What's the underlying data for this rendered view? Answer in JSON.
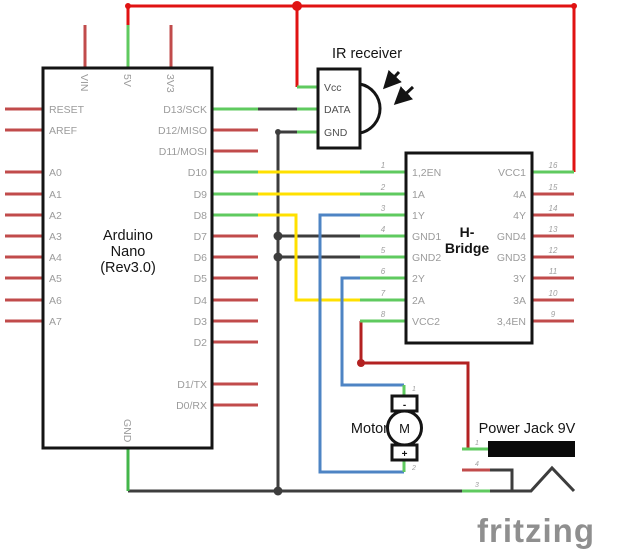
{
  "colors": {
    "wire_red": "#e01212",
    "wire_dark_red": "#b32121",
    "wire_green": "#43b64a",
    "wire_yellow": "#ffe000",
    "wire_blue": "#4e84c4",
    "wire_black": "#3d3d3d",
    "pin_stub_red": "#c14b4b",
    "pin_stub_green": "#5fca5f",
    "pin_label_gray": "#9b9b9b",
    "component_text": "#141414",
    "watermark_gray": "#8f8f8f"
  },
  "arduino": {
    "title_lines": [
      "Arduino",
      "Nano",
      "(Rev3.0)"
    ],
    "pins_left": [
      "RESET",
      "AREF",
      "A0",
      "A1",
      "A2",
      "A3",
      "A4",
      "A5",
      "A6",
      "A7"
    ],
    "pins_right": [
      "D13/SCK",
      "D12/MISO",
      "D11/MOSI",
      "D10",
      "D9",
      "D8",
      "D7",
      "D6",
      "D5",
      "D4",
      "D3",
      "D2",
      "D1/TX",
      "D0/RX"
    ],
    "pins_top": [
      "VIN",
      "5V",
      "3V3"
    ],
    "pin_bottom": "GND"
  },
  "ir_receiver": {
    "title": "IR receiver",
    "pins": [
      "Vcc",
      "DATA",
      "GND"
    ]
  },
  "hbridge": {
    "title_lines": [
      "H-",
      "Bridge"
    ],
    "pins_left": [
      "1,2EN",
      "1A",
      "1Y",
      "GND1",
      "GND2",
      "2Y",
      "2A",
      "VCC2"
    ],
    "pin_numbers_left": [
      "1",
      "2",
      "3",
      "4",
      "5",
      "6",
      "7",
      "8"
    ],
    "pins_right": [
      "VCC1",
      "4A",
      "4Y",
      "GND4",
      "GND3",
      "3Y",
      "3A",
      "3,4EN"
    ],
    "pin_numbers_right": [
      "16",
      "15",
      "14",
      "13",
      "12",
      "11",
      "10",
      "9"
    ]
  },
  "motor": {
    "title": "Motor",
    "symbol": "M",
    "terminal_top": "-",
    "terminal_bottom": "+",
    "pin_numbers": [
      "1",
      "2"
    ]
  },
  "power_jack": {
    "title": "Power Jack 9V",
    "pin_numbers": [
      "1",
      "4",
      "3"
    ]
  },
  "watermark": "fritzing"
}
